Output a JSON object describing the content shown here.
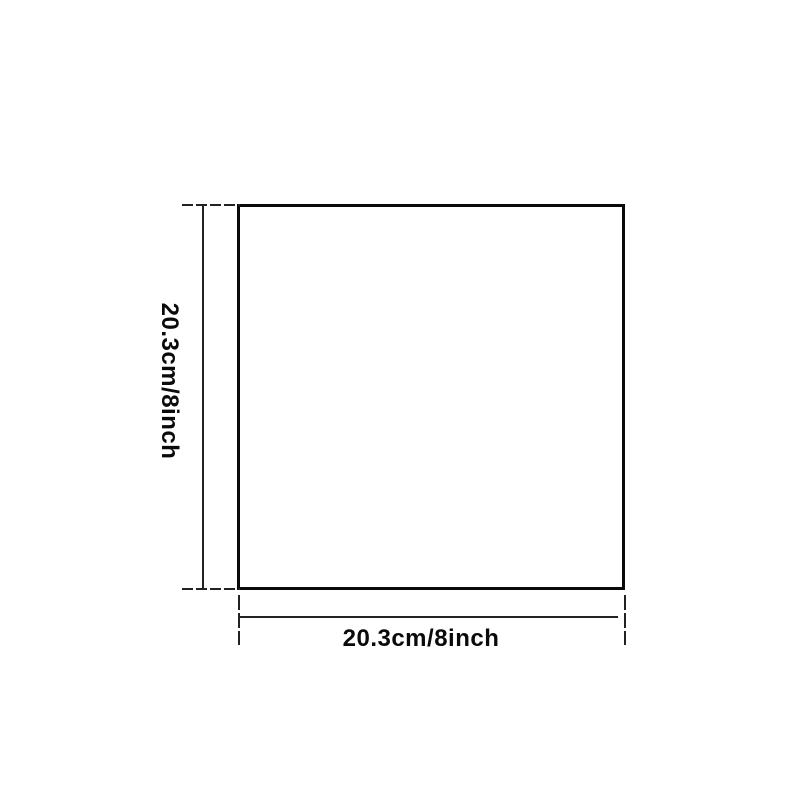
{
  "diagram": {
    "shape": "square",
    "colors": {
      "outline": "#0a0a0a",
      "dimension_lines": "#222222",
      "background": "#ffffff"
    },
    "height_dimension": {
      "label": "20.3cm/8inch"
    },
    "width_dimension": {
      "label": "20.3cm/8inch"
    }
  }
}
